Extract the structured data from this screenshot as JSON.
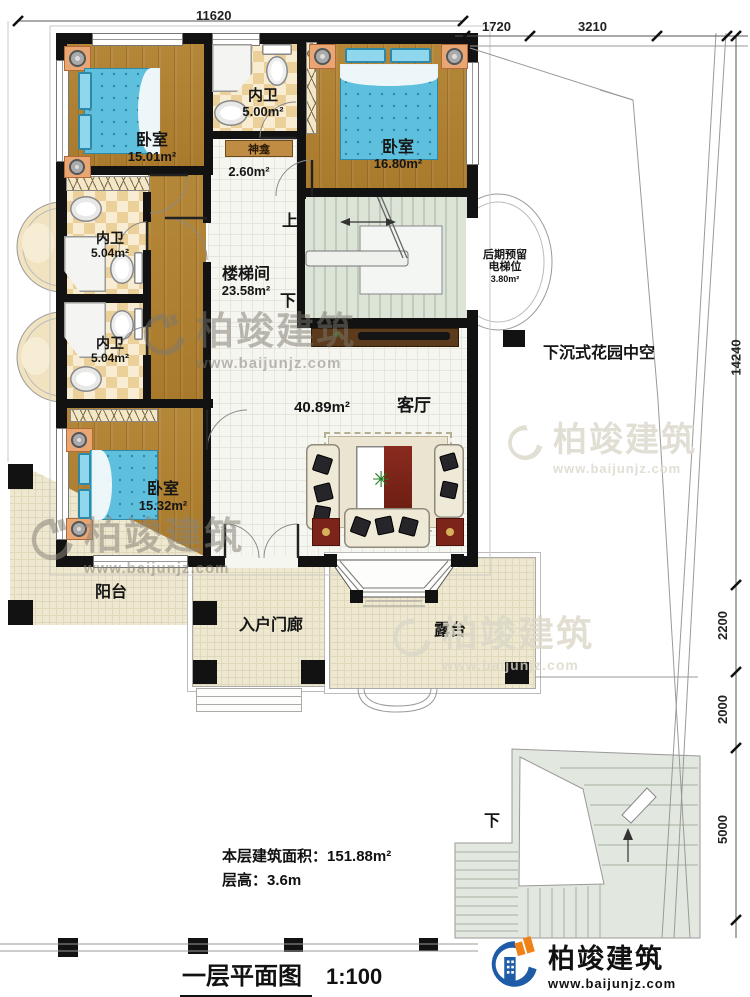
{
  "sheet": {
    "title": "一层平面图",
    "scale": "1:100"
  },
  "brand": {
    "name": "柏竣建筑",
    "website": "www.baijunjz.com"
  },
  "stats": {
    "area_label": "本层建筑面积：",
    "area_value": "151.88m²",
    "floor_height_label": "层高：",
    "floor_height_value": "3.6m"
  },
  "dimensions": {
    "top": "11620",
    "top_right_a": "1720",
    "top_right_b": "3210",
    "right_total": "14240",
    "right_a": "2200",
    "right_b": "2000",
    "right_c": "5000"
  },
  "rooms": {
    "bedroom1": {
      "name": "卧室",
      "area": "15.01m²"
    },
    "bath_top": {
      "name": "内卫",
      "area": "5.00m²"
    },
    "bedroom2": {
      "name": "卧室",
      "area": "16.80m²"
    },
    "shrine": {
      "name": "神龛",
      "area": "2.60m²"
    },
    "bath_mid": {
      "name": "内卫",
      "area": "5.04m²"
    },
    "bath_low": {
      "name": "内卫",
      "area": "5.04m²"
    },
    "stairwell": {
      "name": "楼梯间",
      "area": "23.58m²"
    },
    "elevator": {
      "name_line1": "后期预留",
      "name_line2": "电梯位",
      "area": "3.80m²"
    },
    "living": {
      "name": "客厅",
      "area": "40.89m²"
    },
    "bedroom3": {
      "name": "卧室",
      "area": "15.32m²"
    },
    "balcony": {
      "name": "阳台"
    },
    "porch": {
      "name": "入户门廊"
    },
    "terrace": {
      "name": "露台"
    },
    "garden": {
      "name": "下沉式花园中空"
    }
  },
  "nav": {
    "up": "上",
    "down": "下"
  },
  "colors": {
    "wall": "#121212",
    "wood_floor": "#b08035",
    "bed_blue": "#5fc0de",
    "outdoor_tile": "#eee8d0",
    "stair_green": "#dce3d7",
    "logo_blue": "#1e5ca8",
    "logo_orange": "#f08018"
  }
}
